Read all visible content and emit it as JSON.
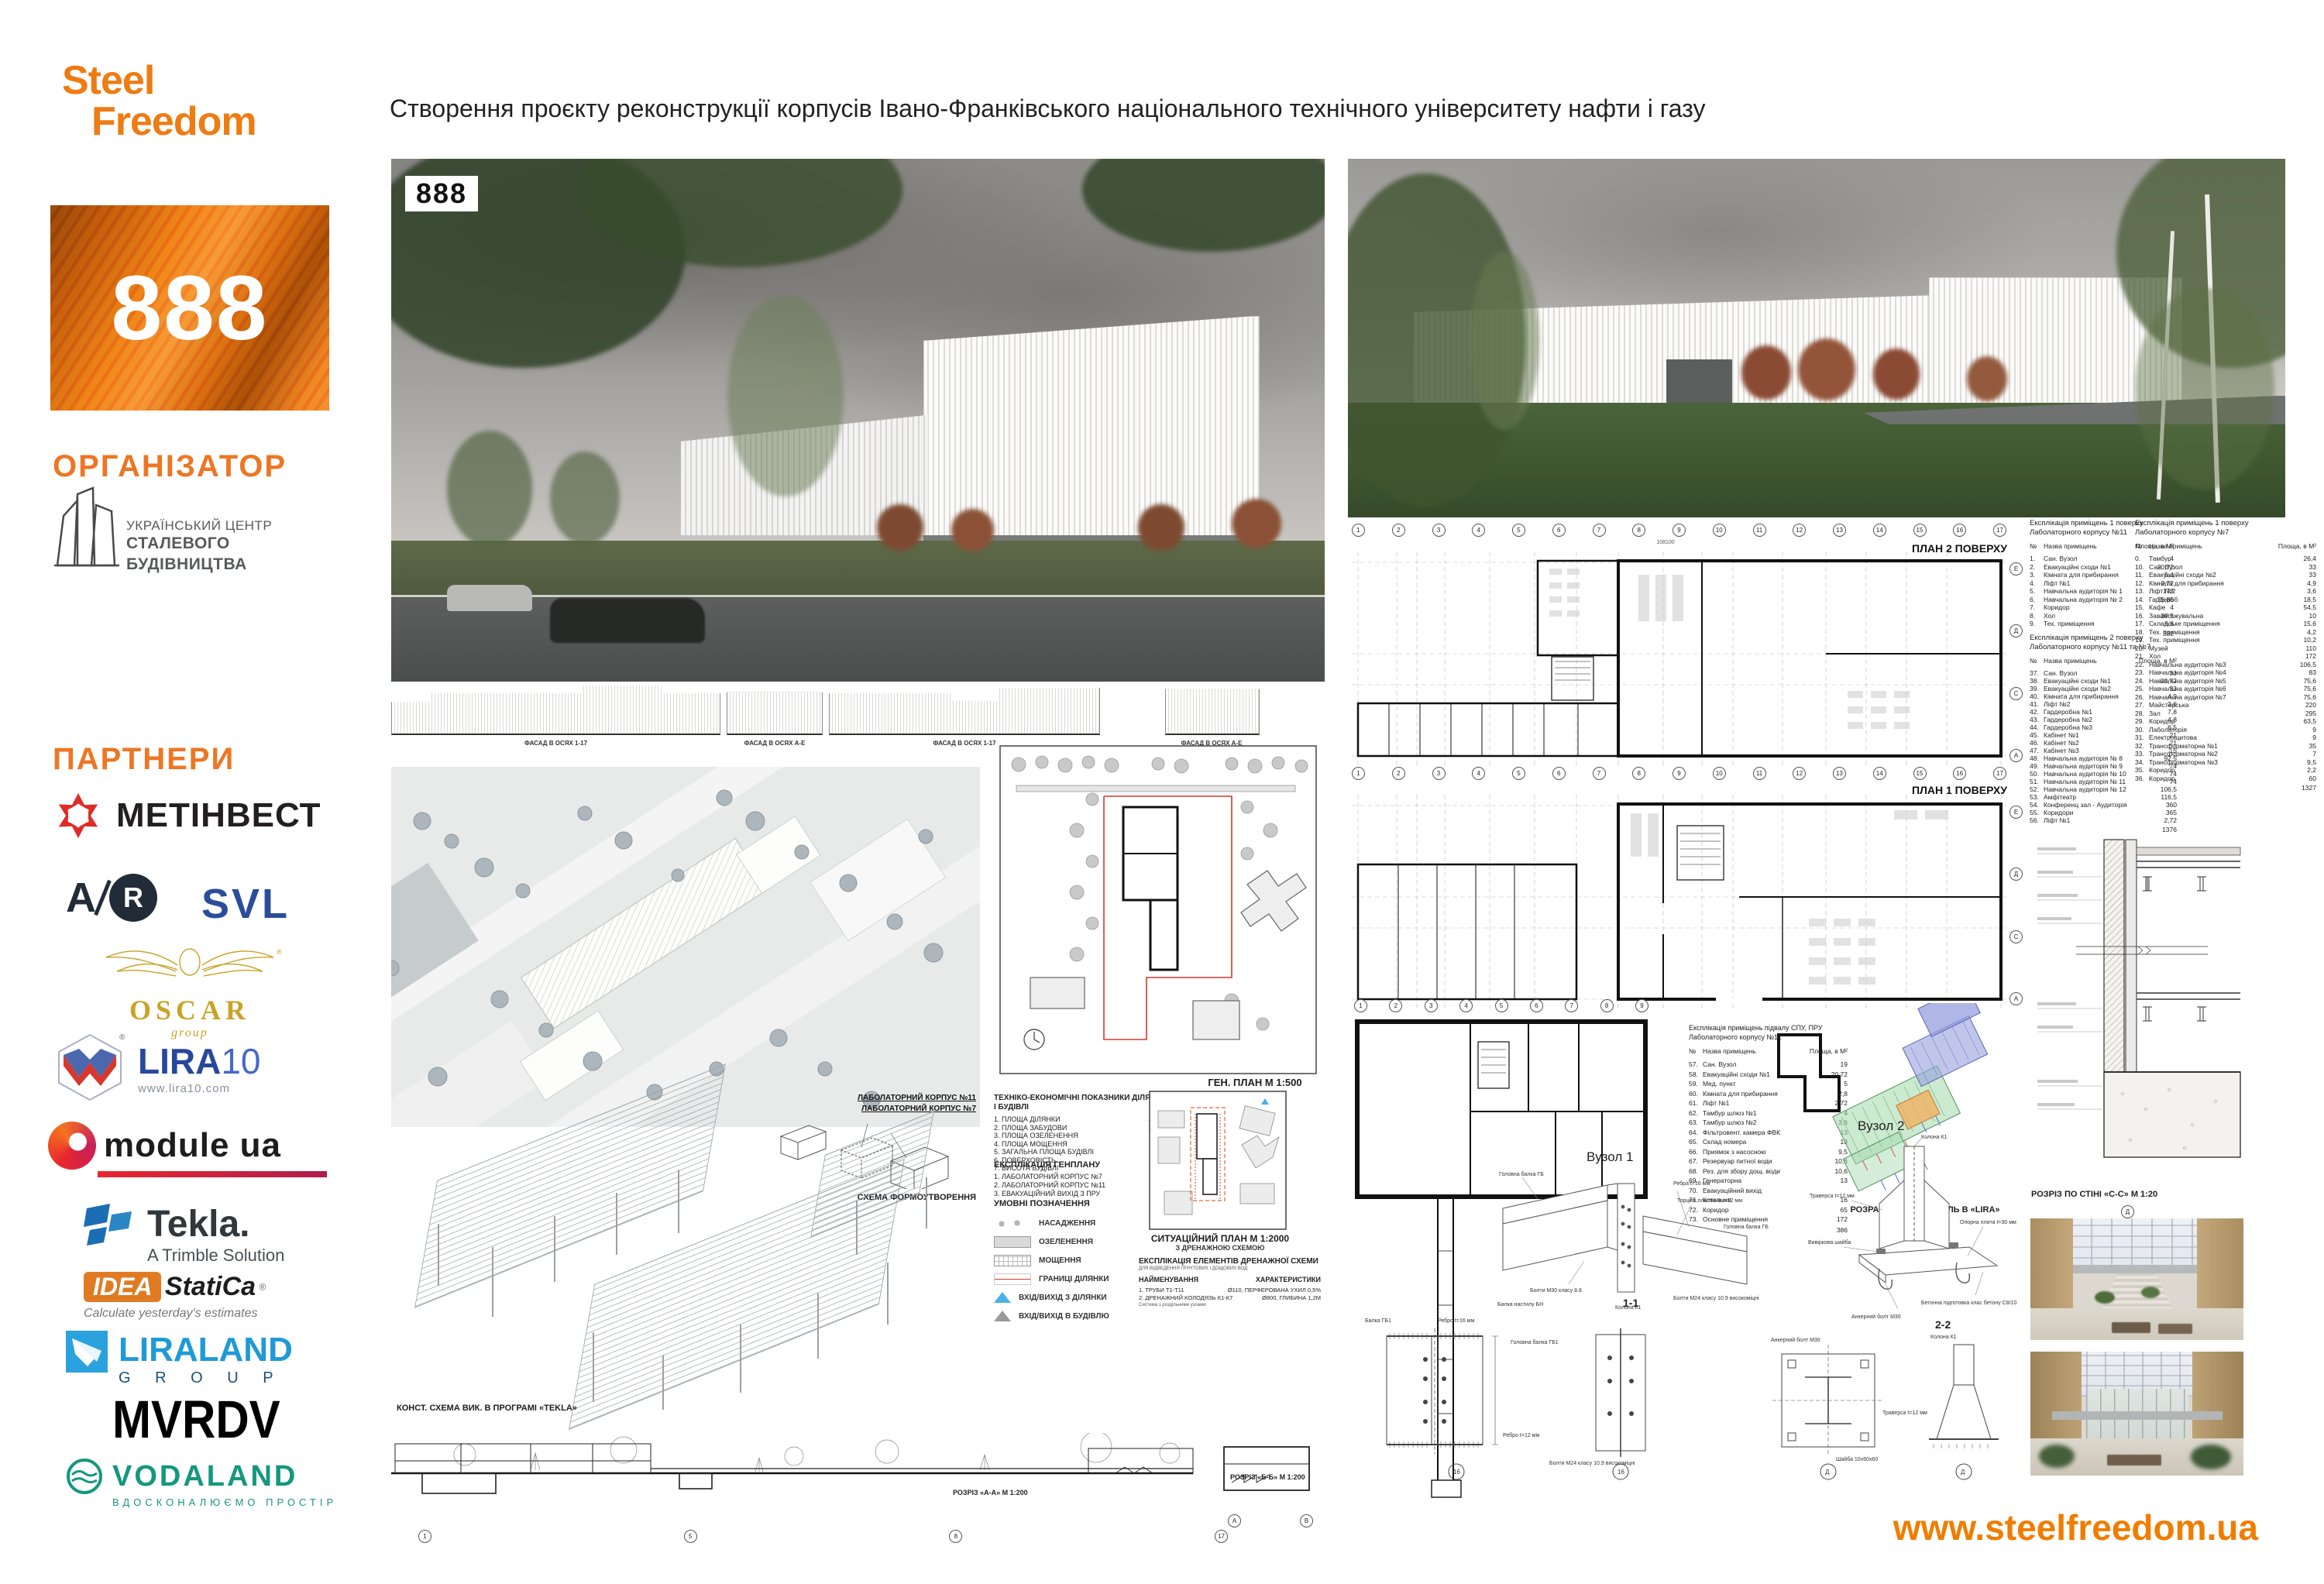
{
  "brand": {
    "logo_line1": "Steel",
    "logo_line2": "Freedom"
  },
  "header": {
    "title": "Створення проєкту реконструкції корпусів Івано-Франківського національного технічного університету нафти і газу"
  },
  "sidebar": {
    "badge": "888",
    "organizer_heading": "ОРГАНІЗАТОР",
    "organizer": {
      "line1": "УКРАЇНСЬКИЙ ЦЕНТР",
      "line2": "СТАЛЕВОГО",
      "line3": "БУДІВНИЦТВА"
    },
    "partners_heading": "ПАРТНЕРИ",
    "partners": {
      "metinvest": "МЕТІНВЕСТ",
      "avr_a": "A",
      "avr_r": "R",
      "svl": "SVL",
      "oscar": {
        "name": "OSCAR",
        "sub": "group"
      },
      "lira": {
        "name": "LIRA",
        "num": "10",
        "url": "www.lira10.com"
      },
      "module": {
        "name": "module ua"
      },
      "tekla": {
        "name": "Tekla.",
        "sub": "A Trimble Solution"
      },
      "idea": {
        "name": "IDEA",
        "name2": "StatiCa",
        "reg": "®",
        "tagline": "Calculate yesterday's estimates"
      },
      "liraland": {
        "name": "LIRALAND",
        "sub": "G R O U P"
      },
      "mvrdv": "MVRDV",
      "vodaland": {
        "name": "VODALAND",
        "tagline": "ВДОСКОНАЛЮЄМО ПРОСТІР"
      }
    }
  },
  "renders": {
    "overlay": "888"
  },
  "elevations": {
    "captions": [
      "ФАСАД В ОСЯХ 1-17",
      "ФАСАД В ОСЯХ А-Е",
      "ФАСАД В ОСЯХ 1-17",
      "ФАСАД В ОСЯХ А-Е"
    ]
  },
  "genplan": {
    "caption": "ГЕН. ПЛАН М 1:500"
  },
  "tech": {
    "title1": "ТЕХНІКО-ЕКОНОМІЧНІ ПОКАЗНИКИ ДІЛЯНКИ",
    "title2": "І БУДІВЛІ",
    "rows": [
      {
        "label": "1. ПЛОЩА ДІЛЯНКИ",
        "value": "3,570 М²"
      },
      {
        "label": "2. ПЛОЩА ЗАБУДОВИ",
        "value": "2,810 М²"
      },
      {
        "label": "3. ПЛОЩА ОЗЕЛЕНЕННЯ",
        "value": "990 М²"
      },
      {
        "label": "4. ПЛОЩА МОЩЕННЯ",
        "value": "502 М²"
      },
      {
        "label": "5. ЗАГАЛЬНА ПЛОЩА БУДІВЛІ",
        "value": "3421 М²"
      },
      {
        "label": "6. ПОВЕРХОВІСТЬ",
        "value": "2"
      },
      {
        "label": "7. ВИСОТА БУДІВЛІ",
        "value": "14М"
      }
    ]
  },
  "expl_gp": {
    "title": "ЕКСПЛІКАЦІЯ ГЕНПЛАНУ",
    "items": [
      "1. ЛАБОЛАТОРНИЙ КОРПУС №7",
      "2. ЛАБОЛАТОРНИЙ КОРПУС №11",
      "3. ЕВАКУАЦІЙНИЙ ВИХІД З ПРУ"
    ]
  },
  "legend": {
    "title": "УМОВНІ ПОЗНАЧЕННЯ",
    "items": [
      "НАСАДЖЕННЯ",
      "ОЗЕЛЕНЕННЯ",
      "МОЩЕННЯ",
      "ГРАНИЦІ ДІЛЯНКИ",
      "ВХІД/ВИХІД З ДІЛЯНКИ",
      "ВХІД/ВИХІД В БУДІВЛЮ"
    ]
  },
  "sitplan": {
    "caption": "СИТУАЦІЙНИЙ ПЛАН М 1:2000",
    "sub": "З ДРЕНАЖНОЮ СХЕМОЮ"
  },
  "drainage": {
    "title": "ЕКСПЛІКАЦІЯ ЕЛЕМЕНТІВ ДРЕНАЖНОЇ СХЕМИ",
    "sub": "ДЛЯ ВІДВЕДЕННЯ ҐРУНТОВИХ І ДОЩОВИХ ВОД",
    "col_name": "НАЙМЕНУВАННЯ",
    "col_char": "ХАРАКТЕРИСТИКИ",
    "rows": [
      {
        "name": "1. ТРУБИ Т1-Т11",
        "char": "Ø110, ПЕРФЕРОВАНА УХИЛ 0,5%"
      },
      {
        "name": "2. ДРЕНАЖНИЙ КОЛОДЯЗЬ К1-К7",
        "char": "Ø800, ГЛИБИНА 1,2М"
      }
    ],
    "note": "Система з роздільними узлами"
  },
  "form_scheme": {
    "label_k11": "ЛАБОЛАТОРНИЙ КОРПУС №11",
    "label_k7": "ЛАБОЛАТОРНИЙ КОРПУС №7",
    "caption": "СХЕМА ФОРМОУТВОРЕННЯ"
  },
  "tekla_scheme": {
    "caption": "КОНСТ. СХЕМА ВИК. В ПРОГРАМІ «TEKLA»"
  },
  "sections": {
    "a": "РОЗРІЗ «А-А» М 1:200",
    "b": "РОЗРІЗ «Б-Б» М 1:200",
    "bubbles_a": [
      "1",
      "5",
      "8",
      "17"
    ],
    "bubbles_b": [
      "А",
      "В"
    ]
  },
  "plans": {
    "plan2_label": "ПЛАН 2 ПОВЕРХУ",
    "plan1_label": "ПЛАН 1 ПОВЕРХУ",
    "grid_total": "108100",
    "grid_nums": [
      "1",
      "2",
      "3",
      "4",
      "5",
      "6",
      "7",
      "8",
      "9",
      "10",
      "11",
      "12",
      "13",
      "14",
      "15",
      "16",
      "17"
    ],
    "grid_letters": [
      "Е",
      "Д",
      "С",
      "А"
    ],
    "bas_nums": [
      "1",
      "2",
      "3",
      "4",
      "5",
      "6",
      "7",
      "8",
      "9"
    ]
  },
  "schedules": {
    "hdr": {
      "n": "№",
      "name": "Назва приміщень",
      "area": "Площа, в М²"
    },
    "f1k11": {
      "title1": "Експлікація приміщень 1 поверху",
      "title2": "Лаболаторного корпусу №11",
      "rows": [
        {
          "n": "1.",
          "name": "Сан. Вузол",
          "area": "4"
        },
        {
          "n": "2.",
          "name": "Евакуаційні сходи №1",
          "area": "20,72"
        },
        {
          "n": "3.",
          "name": "Кімната для прибирання",
          "area": "5,4"
        },
        {
          "n": "4.",
          "name": "Ліфт №1",
          "area": "2,72"
        },
        {
          "n": "5.",
          "name": "Навчальна аудиторія № 1",
          "area": "173"
        },
        {
          "n": "6.",
          "name": "Навчальна аудиторія № 2",
          "area": "75,85"
        },
        {
          "n": "7.",
          "name": "Коридор",
          "area": "4"
        },
        {
          "n": "8.",
          "name": "Хол",
          "area": "39,5"
        },
        {
          "n": "9.",
          "name": "Тех. приміщення",
          "area": "6,8"
        }
      ],
      "total": "332"
    },
    "f1k7": {
      "title1": "Експлікація приміщень 1 поверху",
      "title2": "Лаболаторного корпусу №7",
      "rows": [
        {
          "n": "0.",
          "name": "Тамбур",
          "area": "26,4"
        },
        {
          "n": "10.",
          "name": "Сан. Вузол",
          "area": "33"
        },
        {
          "n": "11.",
          "name": "Евакуаційні сходи №2",
          "area": "33"
        },
        {
          "n": "12.",
          "name": "Кімната для прибирання",
          "area": "4,9"
        },
        {
          "n": "13.",
          "name": "Ліфт №2",
          "area": "3,6"
        },
        {
          "n": "14.",
          "name": "Гардероб",
          "area": "18,5"
        },
        {
          "n": "15.",
          "name": "Кафе",
          "area": "54,5"
        },
        {
          "n": "16.",
          "name": "Завантажувальна",
          "area": "10"
        },
        {
          "n": "17.",
          "name": "Складське приміщення",
          "area": "15,6"
        },
        {
          "n": "18.",
          "name": "Тех. приміщення",
          "area": "4,2"
        },
        {
          "n": "19.",
          "name": "Тех. приміщення",
          "area": "10,2"
        },
        {
          "n": "20.",
          "name": "Музей",
          "area": "110"
        },
        {
          "n": "21.",
          "name": "Хол",
          "area": "172"
        },
        {
          "n": "22.",
          "name": "Навчальна аудиторія №3",
          "area": "106,5"
        },
        {
          "n": "23.",
          "name": "Навчальна аудиторія №4",
          "area": "83"
        },
        {
          "n": "24.",
          "name": "Навчальна аудиторія №5",
          "area": "75,6"
        },
        {
          "n": "25.",
          "name": "Навчальна аудиторія №6",
          "area": "75,6"
        },
        {
          "n": "26.",
          "name": "Навчальна аудиторія №7",
          "area": "75,6"
        },
        {
          "n": "27.",
          "name": "Майстерська",
          "area": "220"
        },
        {
          "n": "28.",
          "name": "Зал",
          "area": "295"
        },
        {
          "n": "29.",
          "name": "Коридор",
          "area": "63,5"
        },
        {
          "n": "30.",
          "name": "Лаболаторія",
          "area": "9"
        },
        {
          "n": "31.",
          "name": "Електрощитова",
          "area": "9"
        },
        {
          "n": "32.",
          "name": "Трансформаторна №1",
          "area": "35"
        },
        {
          "n": "33.",
          "name": "Трансформаторна №2",
          "area": "7"
        },
        {
          "n": "34.",
          "name": "Трансформаторна №3",
          "area": "9,5"
        },
        {
          "n": "35.",
          "name": "Коридор",
          "area": "2,2"
        },
        {
          "n": "36.",
          "name": "Коридор",
          "area": "60"
        }
      ],
      "total": "1327"
    },
    "f2": {
      "title1": "Експлікація приміщень 2 поверху",
      "title2": "Лаболаторного корпусу №11 та №7",
      "rows": [
        {
          "n": "37.",
          "name": "Сан. Вузол",
          "area": "33"
        },
        {
          "n": "38.",
          "name": "Евакуаційні сходи №1",
          "area": "20,72"
        },
        {
          "n": "39.",
          "name": "Евакуаційні сходи №2",
          "area": "33"
        },
        {
          "n": "40.",
          "name": "Кімната для прибирання",
          "area": "4,9"
        },
        {
          "n": "41.",
          "name": "Ліфт №2",
          "area": "3,6"
        },
        {
          "n": "42.",
          "name": "Гардеробна №1",
          "area": "7,8"
        },
        {
          "n": "43.",
          "name": "Гардеробна №2",
          "area": "4,8"
        },
        {
          "n": "44.",
          "name": "Гардеробна №3",
          "area": "6,5"
        },
        {
          "n": "45.",
          "name": "Кабінет №1",
          "area": "21"
        },
        {
          "n": "46.",
          "name": "Кабінет №2",
          "area": "21"
        },
        {
          "n": "47.",
          "name": "Кабінет №3",
          "area": "15"
        },
        {
          "n": "48.",
          "name": "Навчальна аудиторія № 8",
          "area": "92,5"
        },
        {
          "n": "49.",
          "name": "Навчальна аудиторія № 9",
          "area": "74"
        },
        {
          "n": "50.",
          "name": "Навчальна аудиторія № 10",
          "area": "74"
        },
        {
          "n": "51.",
          "name": "Навчальна аудиторія № 11",
          "area": "74"
        },
        {
          "n": "52.",
          "name": "Навчальна аудиторія № 12",
          "area": "106,5"
        },
        {
          "n": "53.",
          "name": "Амфітеатр",
          "area": "116,5"
        },
        {
          "n": "54.",
          "name": "Конференц зал - Аудиторія",
          "area": "360"
        },
        {
          "n": "55.",
          "name": "Коридори",
          "area": "365"
        },
        {
          "n": "56.",
          "name": "Ліфт №1",
          "area": "2,72"
        }
      ],
      "total": "1376"
    },
    "bas": {
      "title1": "Експлікація приміщень підвалу СПУ, ПРУ",
      "title2": "Лаболаторного корпусу №11",
      "rows": [
        {
          "n": "57.",
          "name": "Сан. Вузол",
          "area": "19"
        },
        {
          "n": "58.",
          "name": "Евакуаційні сходи №1",
          "area": "20,72"
        },
        {
          "n": "59.",
          "name": "Мед. пункт",
          "area": "5"
        },
        {
          "n": "60.",
          "name": "Кімната для прибирання",
          "area": "2,8"
        },
        {
          "n": "61.",
          "name": "Ліфт №1",
          "area": "2,72"
        },
        {
          "n": "62.",
          "name": "Тамбур шлюз №1",
          "area": "4"
        },
        {
          "n": "63.",
          "name": "Тамбур шлюз №2",
          "area": "3,6"
        },
        {
          "n": "64.",
          "name": "Фільтровент. камера ФВК",
          "area": "13"
        },
        {
          "n": "65.",
          "name": "Склад номера",
          "area": "19"
        },
        {
          "n": "66.",
          "name": "Приямок з насосною",
          "area": "9,5"
        },
        {
          "n": "67.",
          "name": "Резервуар питної води",
          "area": "10,6"
        },
        {
          "n": "68.",
          "name": "Рез. для збору дощ. води",
          "area": "10,6"
        },
        {
          "n": "69.",
          "name": "Генераторна",
          "area": "13"
        },
        {
          "n": "70.",
          "name": "Евакуаційний вихід",
          "area": ""
        },
        {
          "n": "71.",
          "name": "Котельня",
          "area": "16"
        },
        {
          "n": "72.",
          "name": "Коридор",
          "area": "65"
        },
        {
          "n": "73.",
          "name": "Основне приміщення",
          "area": "172"
        }
      ],
      "total": "386"
    }
  },
  "lira_model": {
    "caption": "РОЗРАХУНКОВА МОДЕЛЬ В «LIRA»"
  },
  "nodes": {
    "n1": {
      "title": "Вузол 1",
      "lbl_beam": "Головна балка ГБ",
      "lbl_ribs": "Ребра t=16 мм",
      "lbl_plates": "Торцеві пластини t=12 мм",
      "lbl_bolts30": "Болти М30 класу 8.8",
      "lbl_deck": "Балка настилу БН",
      "lbl_col": "Колона К1",
      "lbl_bolts24": "Болти М24 класу 10.9 високоміцні"
    },
    "n2": {
      "title": "Вузол 2",
      "lbl_col": "Колона К1",
      "lbl_trav": "Траверса t=12 мм",
      "lbl_washer": "Вивіркова шайба",
      "lbl_plate": "Опорна плита t=30 мм",
      "lbl_anchor": "Анкерний болт М30",
      "lbl_concrete": "Бетонна підготовка клас бетону С8/10"
    }
  },
  "details": {
    "d11": "1-1",
    "d22": "2-2",
    "mark": "16",
    "bubble_d": "Д",
    "lbl_balka": "Балка ГБ1",
    "lbl_golovna": "Головна балка ГБ1",
    "lbl_rebro16": "Ребро t=16 мм",
    "lbl_rebro12": "Ребро t=12 мм",
    "lbl_bolts": "Болти М24 класу 10.9 високоміцні",
    "lbl_kolona": "Колона К1",
    "lbl_anchor": "Анкерний болт М30",
    "lbl_traversa": "Траверса t=12 мм",
    "lbl_shayba": "Шайба 10x60x60"
  },
  "wall_section": {
    "caption": "РОЗРІЗ ПО СТІНІ «С-С» М 1:20"
  },
  "footer": {
    "url": "www.steelfreedom.ua"
  }
}
